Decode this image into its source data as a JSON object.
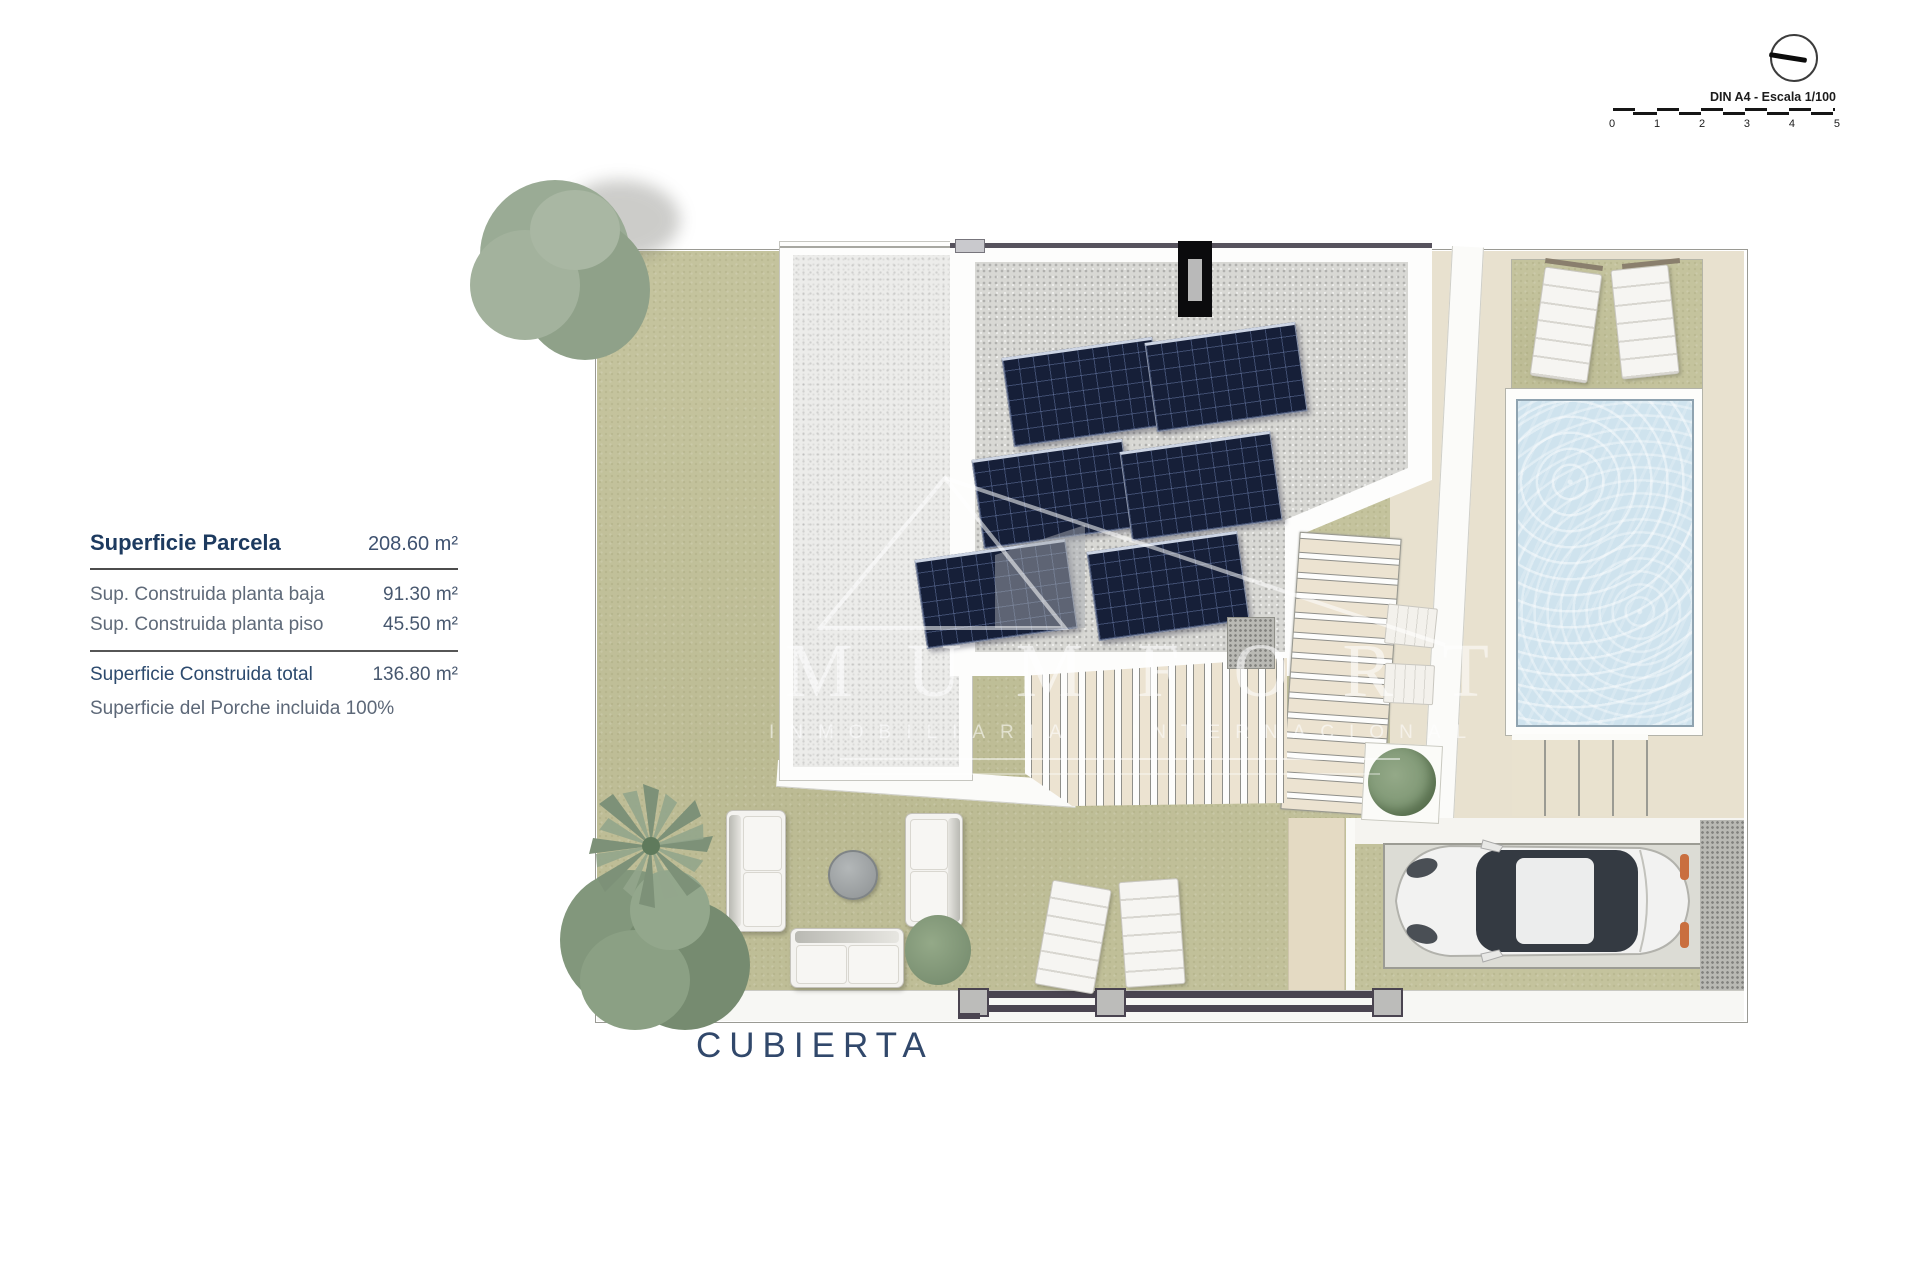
{
  "info_panel": {
    "title_label": "Superficie Parcela",
    "title_value": "208.60 m²",
    "rows": [
      {
        "label": "Sup. Construida planta baja",
        "value": "91.30 m²"
      },
      {
        "label": "Sup. Construida planta piso",
        "value": "45.50 m²"
      }
    ],
    "total_label": "Superficie Construida total",
    "total_value": "136.80 m²",
    "note": "Superficie del Porche incluida 100%"
  },
  "plan": {
    "label": "CUBIERTA"
  },
  "scale_bar": {
    "caption": "DIN A4 - Escala 1/100",
    "ticks": [
      "0",
      "1",
      "2",
      "3",
      "4",
      "5"
    ]
  },
  "watermark": {
    "brand": "MUMFORT",
    "subtitle": "INMOBILIARIA INTERNACIONAL"
  },
  "colors": {
    "grass": "#c4c39d",
    "deck_beige": "#e8e1cf",
    "pool_water": "#cfe3ee",
    "solar_panel": "#161f38",
    "navy_text": "#1f3a60",
    "fence": "#4a4450",
    "roof_gravel": "#d8d8d4",
    "terrace_gravel": "#ececea"
  }
}
